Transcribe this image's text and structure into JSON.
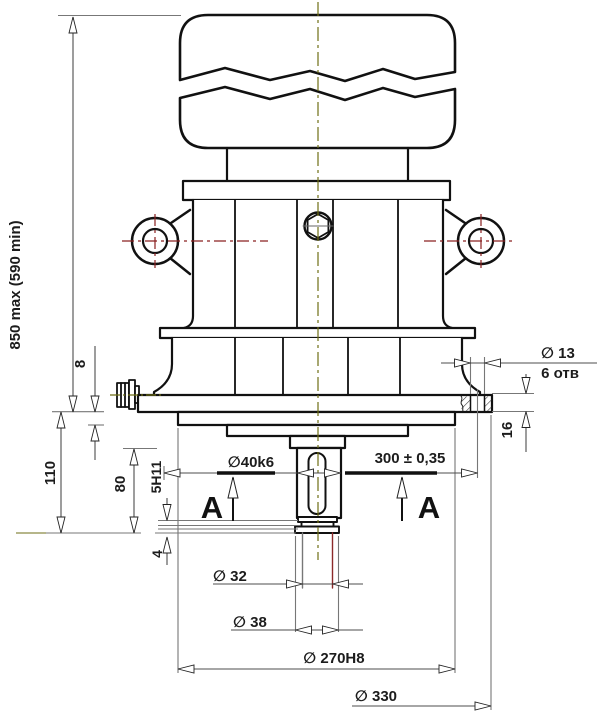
{
  "drawing": {
    "dims": {
      "overall": "850 max (590 min)",
      "flange_offset": "110",
      "shaft_length": "80",
      "step_height": "8",
      "keyway": "5H11",
      "groove": "4",
      "shaft_dia": "⁀40k6",
      "bolt_circle": "300 ± 0,35",
      "hole_dia": "⁀ 13",
      "hole_count": "6 отв",
      "flange_thickness": "16",
      "dia_32": "⁀ 32",
      "dia_38": "⁀ 38",
      "spigot_dia": "⁀ 270H8",
      "flange_dia": "⁀ 330",
      "section_label": "A"
    },
    "colors": {
      "outline": "#111111",
      "dimension": "#4d4d4d",
      "centerline_olive": "#6e6e14",
      "centerline_red": "#8a2020"
    }
  }
}
